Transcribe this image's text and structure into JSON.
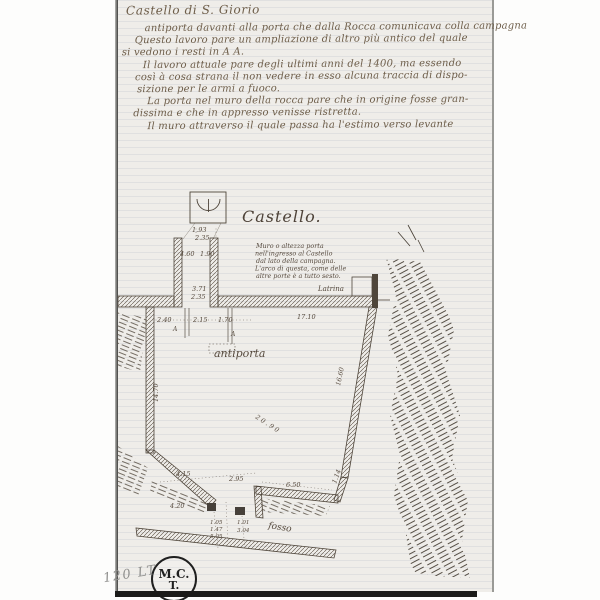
{
  "document": {
    "title": "Castello di S. Giorio",
    "manuscript_lines": [
      "antiporta davanti alla porta che dalla Rocca comunicava colla campagna",
      "Questo lavoro pare un ampliazione di altro più antico del quale",
      "si vedono i resti in A A.",
      "Il lavoro attuale pare degli ultimi anni del 1400, ma essendo",
      "così à cosa strana il non vedere in esso alcuna traccia di dispo-",
      "sizione per le armi a fuoco.",
      "La porta nel muro della rocca pare che in origine fosse gran-",
      "dissima e che in appresso venisse ristretta.",
      "Il muro attraverso il quale passa ha l'estimo verso levante"
    ]
  },
  "drawing": {
    "plan_title": "Castello.",
    "note_lines": [
      "Muro o altezza porta",
      "nell'ingresso al Castello",
      "dal lato della campagna.",
      "L'arco di questa, come delle",
      "altre porte è a tutto sesto."
    ],
    "labels": {
      "antiporta": "antiporta",
      "latrina": "Latrina",
      "fosso": "fosso",
      "marker_a": "A"
    },
    "dims": {
      "arch_w1": "1.93",
      "arch_w2": "2.35",
      "tower_in_l": "4.60",
      "tower_in_r": "1.90",
      "gate_d1": "3.71",
      "gate_d2": "2.35",
      "row_1": "2.40",
      "row_2": "2.15",
      "row_3": "1.70",
      "wall_top": "17.10",
      "wall_left": "14.70",
      "diag": "20.90",
      "wall_right": "16.60",
      "bl_1": "4.15",
      "gate_b": "2.95",
      "wall_br": "6.50",
      "bl_2": "4.20",
      "corner_br": "1.14",
      "g1": "1.05",
      "g2": "1.47",
      "g3": "5.05",
      "g4": "1.01",
      "g5": "3.04"
    }
  },
  "footer": {
    "stamp_line1": "M.C.",
    "stamp_line2": "T.",
    "pencil_note": "120 LT"
  },
  "colors": {
    "paper": "#efede9",
    "manuscript_ink": "#6d5d49",
    "drawing_ink": "#4f463b",
    "pencil": "#8f8f8d",
    "stamp": "#1f1f1f"
  }
}
